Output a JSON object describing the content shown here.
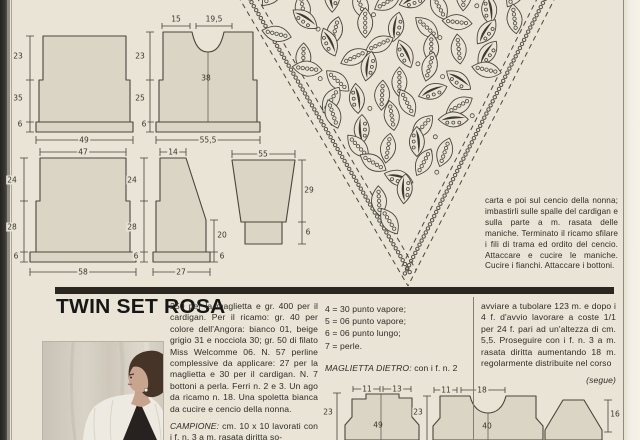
{
  "article": {
    "title": "TWIN SET ROSA",
    "materials_text": "250 per la maglietta e gr. 400 per il cardigan. Per il ricamo: gr. 40 per colore dell'Angora: bianco 01, beige grigio 31 e nocciola 30; gr. 50 di filato Miss Welcomme 06. N. 57 perline complessive da applicare: 27 per la maglietta e 30 per il cardigan. N. 7 bottoni a perla. Ferri n. 2 e 3. Un ago da ricamo n. 18. Una spoletta bianca da cucire e cencio della nonna.",
    "campione_label": "CAMPIONE:",
    "campione_text": " cm. 10 x 10 lavorati con i f. n. 3 a m. rasata diritta so-",
    "legend": [
      "4 = 30 punto vapore;",
      "5 = 06 punto vapore;",
      "6 = 06 punto lungo;",
      "7 = perle."
    ],
    "maglietta_label": "MAGLIETTA DIETRO:",
    "maglietta_text": " con i f. n. 2",
    "instructions_right": "avviare a tubolare 123 m. e dopo i 4 f. d'avvio lavorare a coste 1/1 per 24 f. pari ad un'altezza di cm. 5,5. Proseguire con i f. n. 3 a m. rasata diritta aumentando 18 m. regolarmente distribuite nel corso",
    "segue": "(segue)",
    "finishing_text": "carta e poi sul cencio della nonna; imbastirli sulle spalle del cardigan e sulla parte a m. rasata delle maniche. Terminato il ricamo sfilare i fili di trama ed ordito del cencio. Attaccare e cucire le maniche. Cucire i fianchi. Attaccare i bottoni."
  },
  "diagrams": {
    "a": {
      "h1": "23",
      "h2": "35",
      "h3": "6",
      "w": "49"
    },
    "b": {
      "t1": "15",
      "t2": "19,5",
      "h1": "23",
      "h2": "25",
      "mid": "38",
      "h3": "6",
      "w": "55,5"
    },
    "c": {
      "t": "47",
      "h1": "24",
      "h2": "28",
      "h3": "6",
      "w": "58"
    },
    "d": {
      "t": "14",
      "h1": "24",
      "h2": "28",
      "h3": "6",
      "r1": "20",
      "r2": "6",
      "w": "27"
    },
    "e": {
      "t": "55",
      "r1": "29",
      "r2": "6"
    },
    "f": {
      "t1": "11",
      "t2": "13",
      "h1": "23",
      "mid": "49"
    },
    "g": {
      "t1": "11",
      "t2": "18",
      "h1": "23",
      "mid": "40"
    },
    "h": {
      "r1": "16"
    }
  },
  "colors": {
    "paper": "#e9e4d6",
    "piece_fill": "#dbd5c5",
    "ink": "#46423a",
    "divider_bar": "#2b2720"
  }
}
